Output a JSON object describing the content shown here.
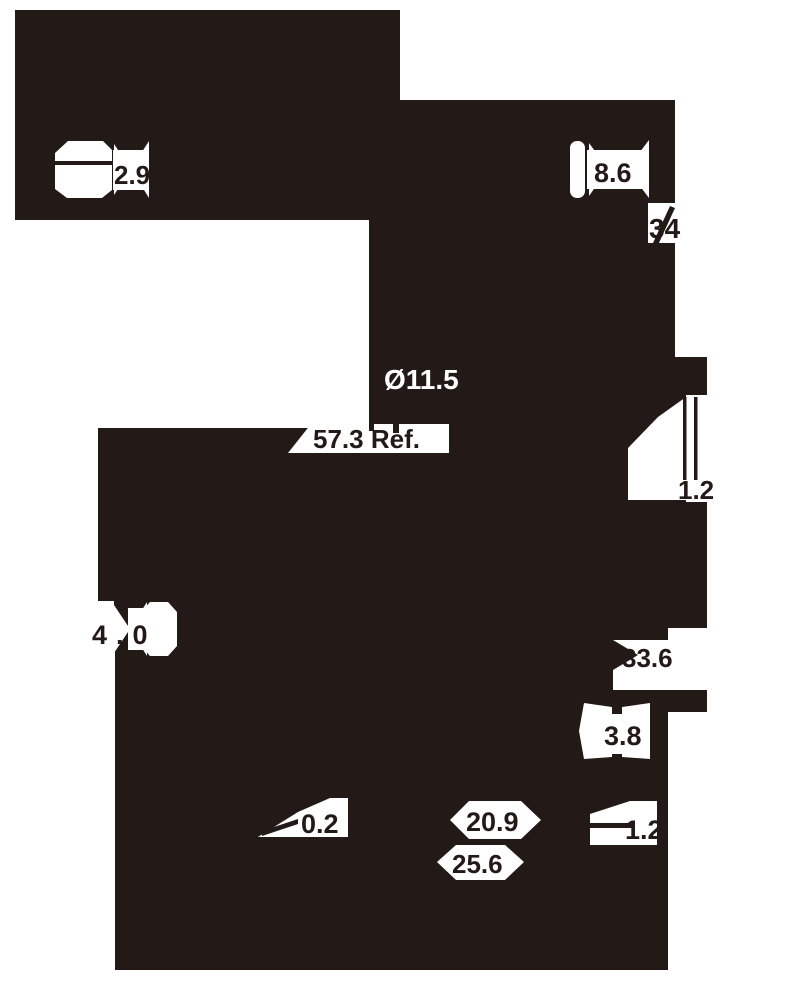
{
  "drawing": {
    "colors": {
      "ink": "#231916",
      "paper": "#ffffff"
    },
    "labels": {
      "dim_2_9": "2.9",
      "dim_8_6": "8.6",
      "dim_34": "34",
      "dim_dia_11_5": "Ø11.5",
      "dim_57_3_ref": "57.3 Ref.",
      "dim_1_2_right": "1.2",
      "dim_4_0": "4.0",
      "dim_33_6": "33.6",
      "dim_3_8": "3.8",
      "dim_0_2": "0.2",
      "dim_20_9": "20.9",
      "dim_1_2_bottom": "1.2",
      "dim_25_6": "25.6"
    }
  }
}
